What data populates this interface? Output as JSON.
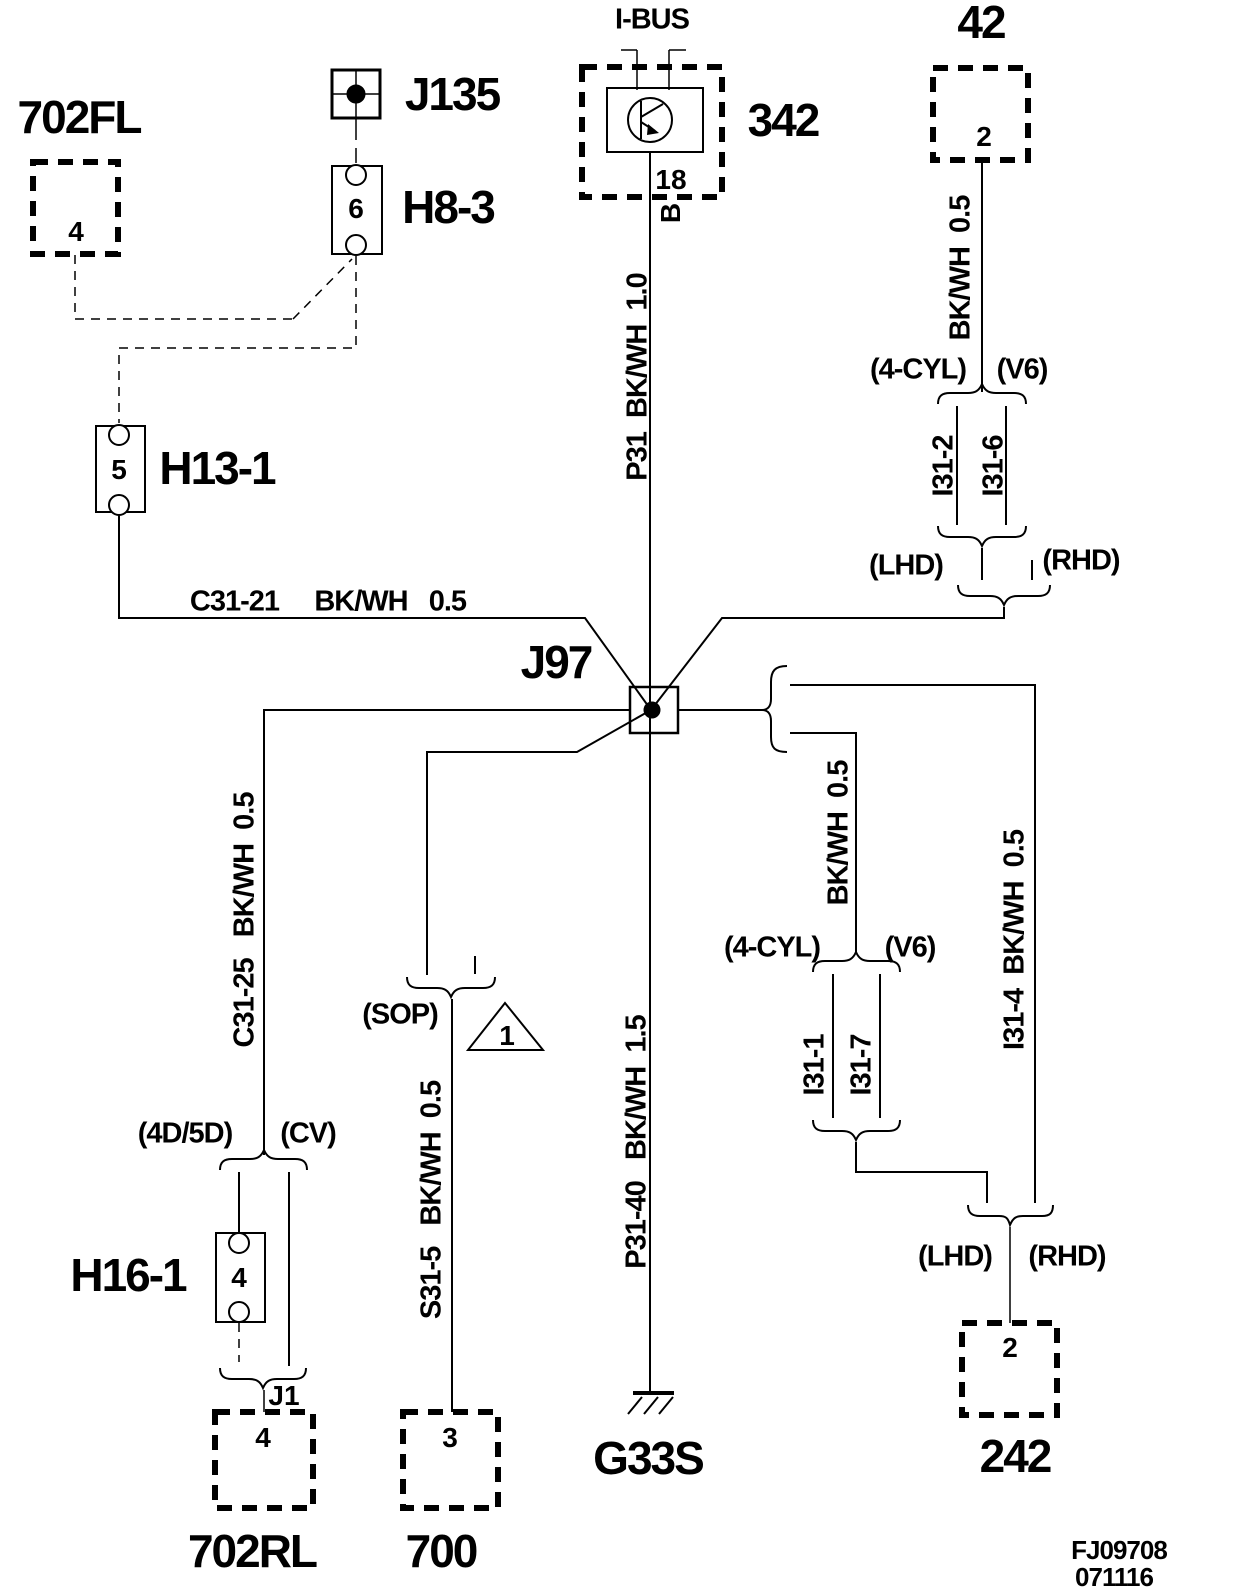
{
  "components": {
    "c702fl": {
      "label": "702FL",
      "pin": "4"
    },
    "j135": {
      "label": "J135"
    },
    "h8_3": {
      "label": "H8-3",
      "pin": "6"
    },
    "h13_1": {
      "label": "H13-1",
      "pin": "5"
    },
    "c342": {
      "label": "342",
      "bus": "I-BUS",
      "pin": "18",
      "pin_b": "B"
    },
    "c42": {
      "label": "42",
      "pin": "2"
    },
    "j97": {
      "label": "J97"
    },
    "h16_1": {
      "label": "H16-1",
      "pin": "4"
    },
    "c702rl": {
      "label": "702RL",
      "pin": "4"
    },
    "c700": {
      "label": "700",
      "pin": "3"
    },
    "g33s": {
      "label": "G33S"
    },
    "c242": {
      "label": "242",
      "pin": "2"
    },
    "j1": {
      "label": "J1"
    }
  },
  "wires": {
    "p31": "P31  BK/WH  1.0",
    "c31_21": "C31-21     BK/WH   0.5",
    "bkwh_top_right": "BK/WH  0.5",
    "c31_25": "C31-25   BK/WH  0.5",
    "s31_5": "S31-5   BK/WH  0.5",
    "p31_40": "P31-40   BK/WH  1.5",
    "bkwh_mid_right": "BK/WH  0.5",
    "i31_4": "I31-4  BK/WH  0.5",
    "i31_2": "I31-2",
    "i31_6": "I31-6",
    "i31_1": "I31-1",
    "i31_7": "I31-7"
  },
  "variants": {
    "four_cyl_top": "(4-CYL)",
    "v6_top": "(V6)",
    "lhd_top": "(LHD)",
    "rhd_top": "(RHD)",
    "four_cyl_mid": "(4-CYL)",
    "v6_mid": "(V6)",
    "lhd_bottom": "(LHD)",
    "rhd_bottom": "(RHD)",
    "sop": "(SOP)",
    "d4_5d": "(4D/5D)",
    "cv": "(CV)"
  },
  "notes": {
    "triangle": "1"
  },
  "footer": {
    "code": "FJ09708",
    "date": "071116"
  },
  "colors": {
    "line": "#000000",
    "background": "#ffffff"
  }
}
